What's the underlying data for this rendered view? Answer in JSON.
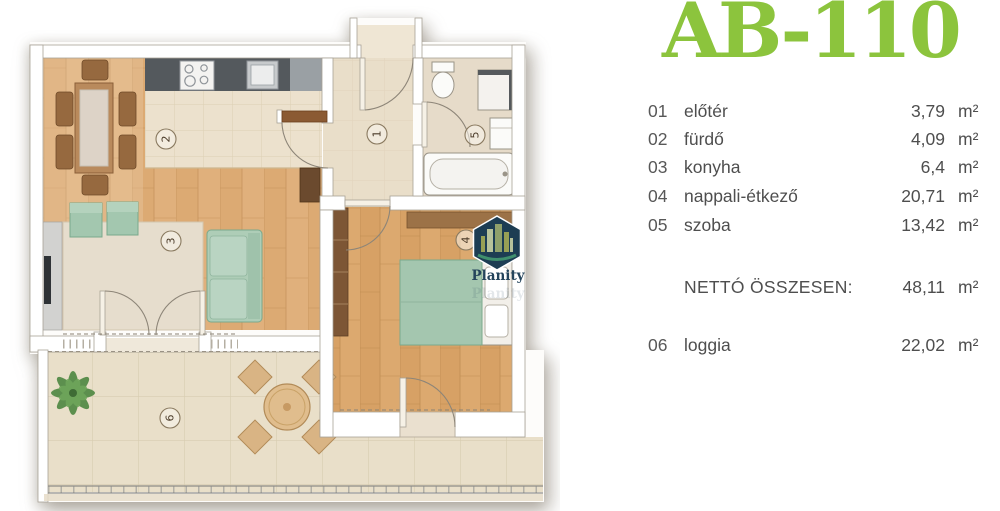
{
  "title": "AB-110",
  "legend": {
    "rows": [
      {
        "num": "01",
        "name": "előtér",
        "value": "3,79",
        "unit": "m²"
      },
      {
        "num": "02",
        "name": "fürdő",
        "value": "4,09",
        "unit": "m²"
      },
      {
        "num": "03",
        "name": "konyha",
        "value": "6,4",
        "unit": "m²"
      },
      {
        "num": "04",
        "name": "nappali-étkező",
        "value": "20,71",
        "unit": "m²"
      },
      {
        "num": "05",
        "name": "szoba",
        "value": "13,42",
        "unit": "m²"
      }
    ],
    "total": {
      "label": "NETTÓ ÖSSZESEN:",
      "value": "48,11",
      "unit": "m²"
    },
    "extra": {
      "num": "06",
      "name": "loggia",
      "value": "22,02",
      "unit": "m²"
    }
  },
  "floorplan": {
    "room_numbers": {
      "hall": "1",
      "kitchen": "2",
      "living": "3",
      "bedroom": "4",
      "bathroom": "5",
      "loggia": "6"
    },
    "watermark": "Planity",
    "colors": {
      "title_green": "#8cc43d",
      "legend_text": "#4e4e4e",
      "wood_floor": "#dcaa73",
      "bedroom_wood": "#d7a165",
      "tile_floor": "#ece1cd",
      "hall_floor": "#e9dec9",
      "loggia_tile": "#e9dfc9",
      "carpet": "#e6ddcd",
      "furniture_green": "#aecdb7",
      "furniture_brown": "#96693f",
      "counter_gray": "#54595d",
      "wall_white": "#ffffff",
      "logo_navy": "#1d3d53"
    }
  }
}
